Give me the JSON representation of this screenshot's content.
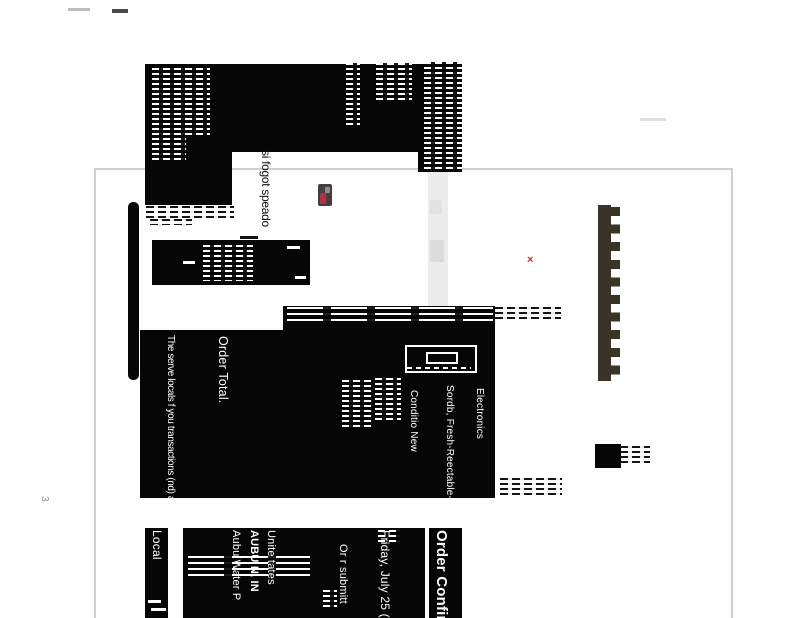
{
  "page_number": "3",
  "header": {
    "shipping_note": "si fogot speado"
  },
  "summary": {
    "legal_note": "The serve locals f you transactions (nd) a, dcplena; auodeb al",
    "order_total_label": "Order Total.",
    "item_condition": "Conditio  New",
    "item_name": "Sordb, Fresh-Reectable-201.",
    "item_category": "Electronics"
  },
  "footer": {
    "local_label": "Local",
    "address_line1": "Aubu  Water P",
    "address_line2": "AUBU N, IN",
    "address_line3": "Unite  tates",
    "submitted_note": "Or  r submitt",
    "order_date": "Friday, July 25 (",
    "title": "Order Confirm"
  },
  "marks": {
    "red_mark": "×"
  },
  "colors": {
    "scan_black": "#060606",
    "frame_gray": "#cfcfcf",
    "binding_strip": "#3a3427",
    "red_accent": "#c0392b",
    "logo_red": "#b5303c"
  }
}
